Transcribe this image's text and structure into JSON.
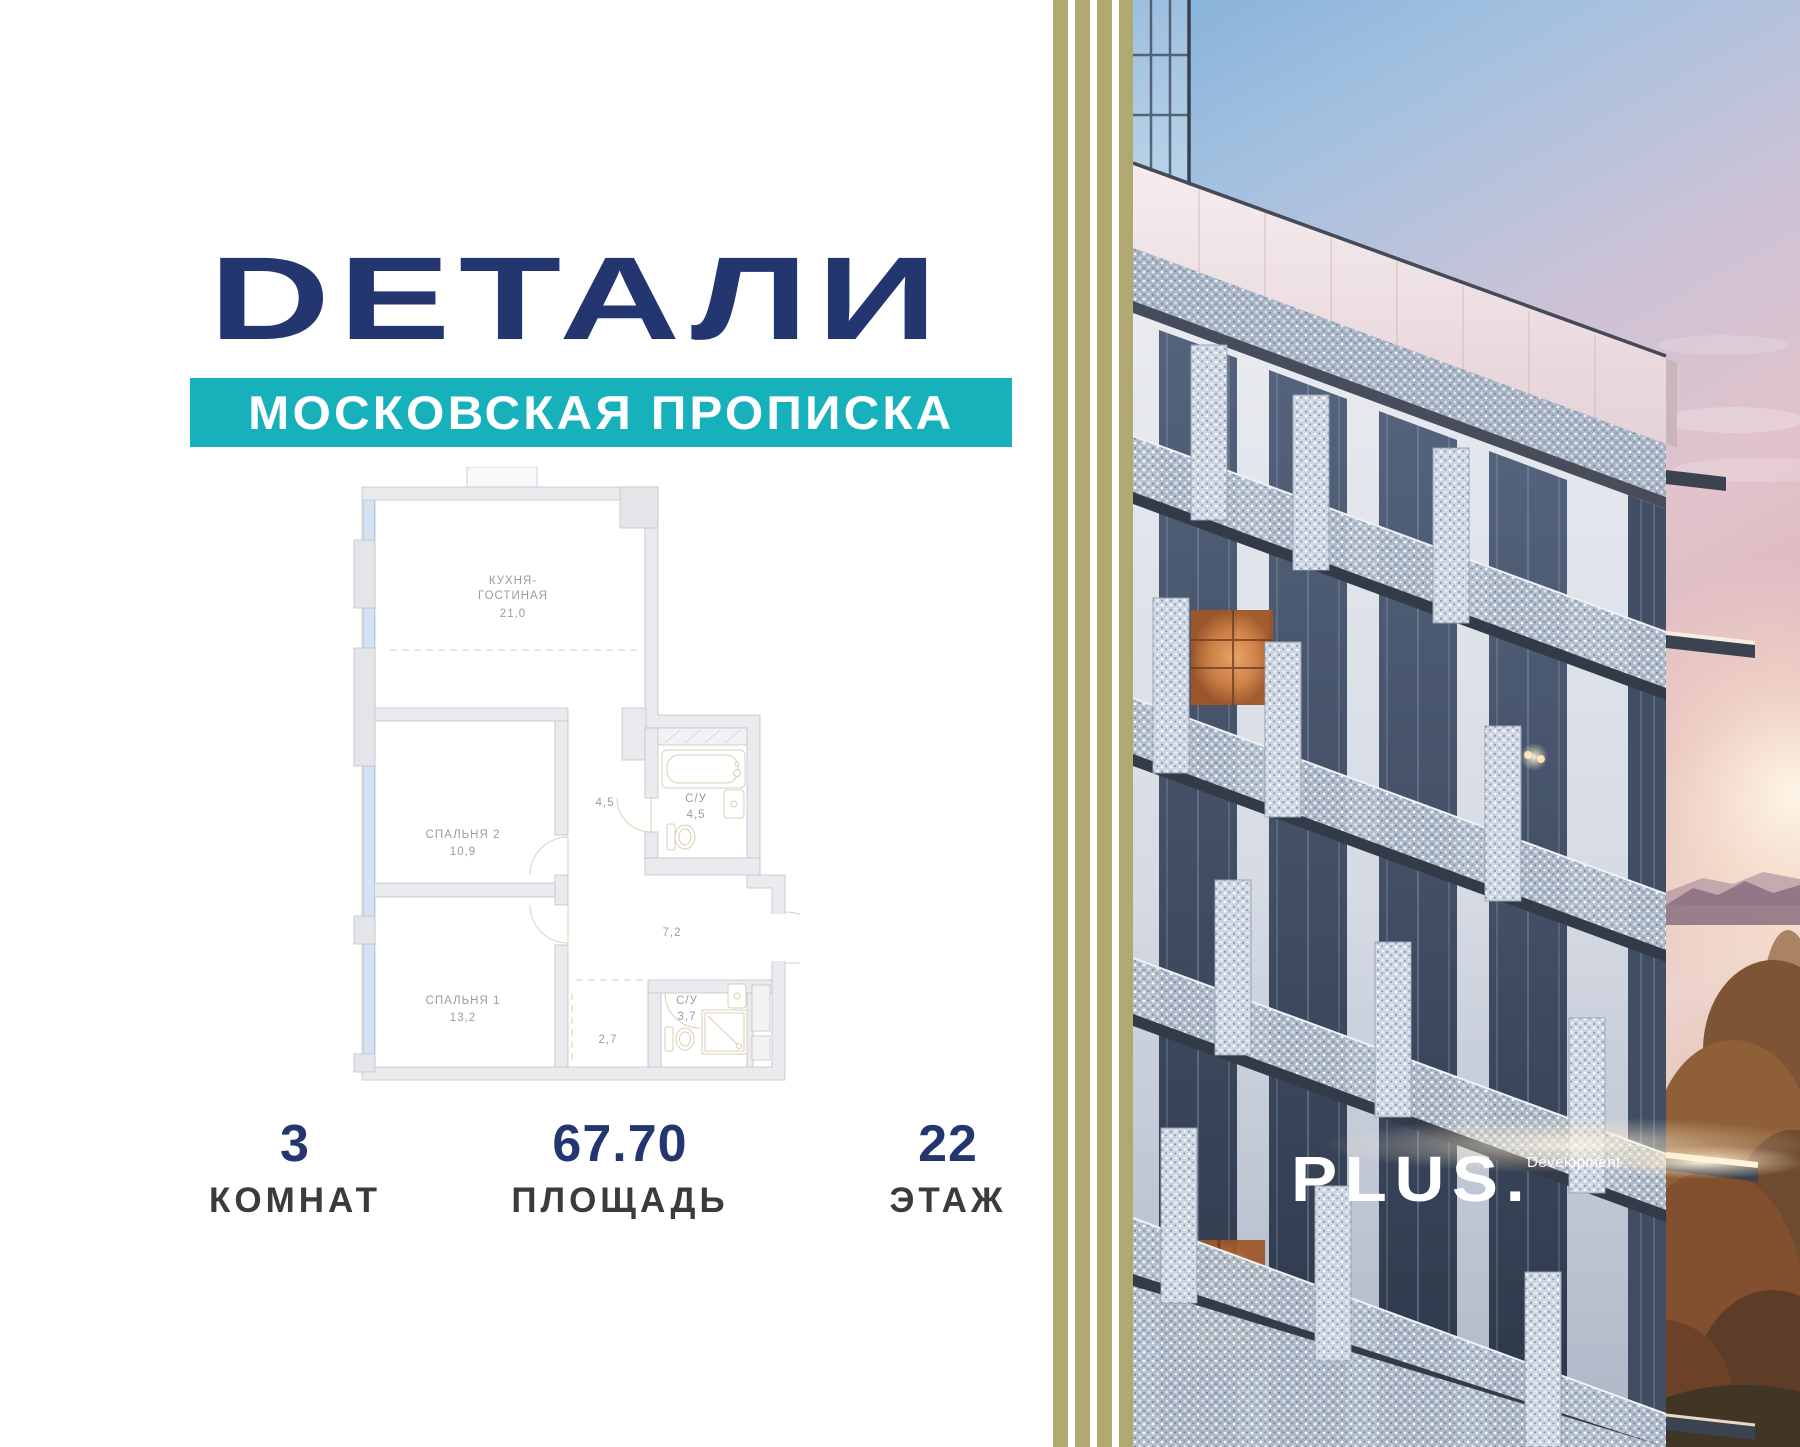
{
  "logo": {
    "text": "DЕТАЛИ"
  },
  "banner": {
    "text": "МОСКОВСКАЯ ПРОПИСКА"
  },
  "plan": {
    "kitchen": {
      "line1": "КУХНЯ-",
      "line2": "ГОСТИНАЯ",
      "area": "21,0"
    },
    "bedroom2": {
      "name": "СПАЛЬНЯ 2",
      "area": "10,9"
    },
    "bedroom1": {
      "name": "СПАЛЬНЯ 1",
      "area": "13,2"
    },
    "bath_top": {
      "name": "С/У",
      "area": "4,5"
    },
    "bath_bottom": {
      "name": "С/У",
      "area": "3,7"
    },
    "hall": {
      "area": "4,5"
    },
    "corridor": {
      "area": "7,2"
    },
    "hall_small": {
      "area": "2,7"
    }
  },
  "stats": {
    "rooms": {
      "value": "3",
      "label": "КОМНАТ"
    },
    "area": {
      "value": "67.70",
      "label": "ПЛОЩАДЬ"
    },
    "floor": {
      "value": "22",
      "label": "ЭТАЖ"
    }
  },
  "developer": {
    "brand": "PLUS.",
    "suffix": "Development"
  },
  "colors": {
    "navy": "#243670",
    "teal": "#16b1bb",
    "stripe_olive": "#b1a972",
    "plan_line_beige": "#d8cfb2",
    "plan_label_gray": "#979ca2"
  }
}
